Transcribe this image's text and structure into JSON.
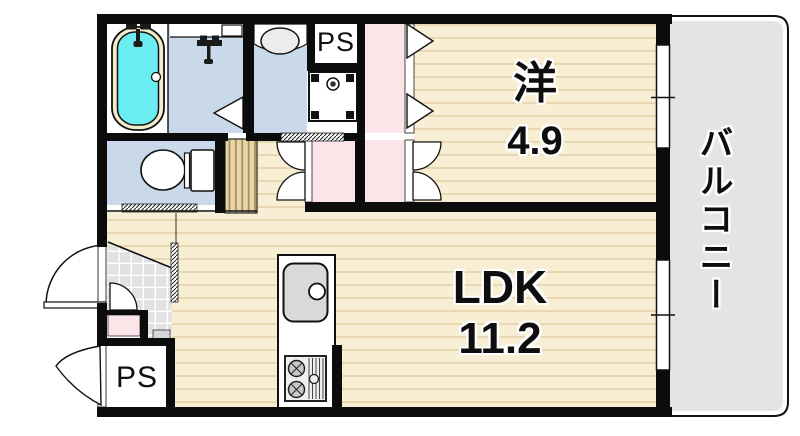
{
  "floor_plan": {
    "type": "apartment-floor-plan",
    "rooms": {
      "western_room": {
        "name": "洋",
        "size": "4.9"
      },
      "ldk": {
        "name": "LDK",
        "size": "11.2"
      },
      "balcony": {
        "name": "バルコニー"
      },
      "pipe_space_top": {
        "name": "PS"
      },
      "pipe_space_bottom": {
        "name": "PS"
      }
    },
    "colors": {
      "wall": "#0c0c0c",
      "floor_wood": "#f8eed3",
      "floor_wood_line": "#e9d7b2",
      "wet_room_blue": "#c9d9e9",
      "closet_pink": "#fce5e9",
      "bath_water_cyan": "#6aeef2",
      "bath_rim_cream": "#f3ecca",
      "balcony_gray": "#e4e4e4",
      "entrance_tile_gray": "#e2e2e2",
      "louver_tan": "#e9d6a4",
      "fixture_gray": "#d9d9d9"
    }
  }
}
